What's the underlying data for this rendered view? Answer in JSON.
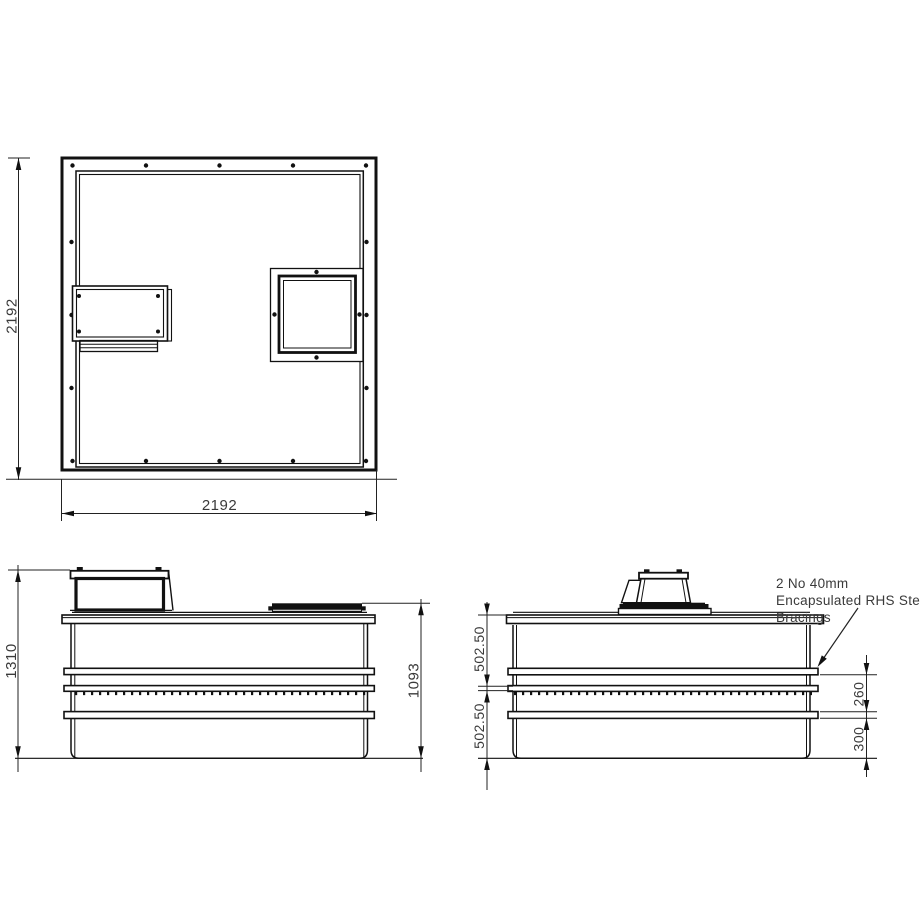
{
  "drawing_title": "Tank / enclosure fabrication drawing, three orthographic views",
  "plan_view": {
    "dim_width": "2192",
    "dim_height": "2192"
  },
  "front_elevation": {
    "dim_overall_height": "1310",
    "dim_body_height": "1093"
  },
  "side_elevation": {
    "dim_upper_section": "502.50",
    "dim_lower_section": "502.50",
    "dim_bracing_gap": "260",
    "dim_base_height": "300",
    "annotation": {
      "line1": "2 No 40mm",
      "line2": "Encapsulated RHS Steel",
      "line3": "Bracings"
    }
  },
  "colors": {
    "line": "#111111",
    "dim_text": "#3a3a3a",
    "background": "#ffffff"
  }
}
